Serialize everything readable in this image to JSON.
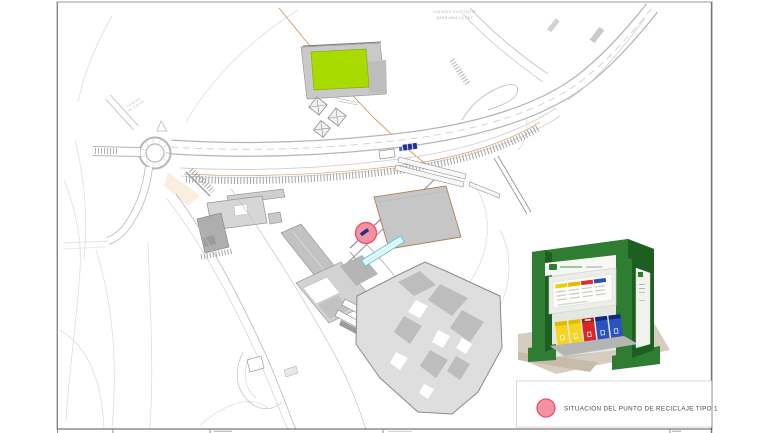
{
  "sheet": {
    "background": "#ffffff",
    "frame_color": "#9a9a9a"
  },
  "annotations": {
    "school_label_line1": "COLEGIO EXISTENTE",
    "school_label_line2": "BARRIADA LA PAZ",
    "health_label_line1": "CENTRO",
    "health_label_line2": "DE SALUD"
  },
  "map": {
    "colors": {
      "sports_court": "#a8dc00",
      "sports_court_stroke": "#86b300",
      "ramp_fill": "#eafafc",
      "ramp_stroke": "#4cc9d9",
      "boundary": "#d09a62",
      "existing_containers": "#23309b"
    },
    "recycling_marker": {
      "fill": "#f492a0",
      "stroke": "#e8556e",
      "symbol_color": "#24308f"
    }
  },
  "inset": {
    "subject": "punto-de-reciclaje-3d-render",
    "structure_green": "#2e7d32",
    "structure_green_dark": "#1d5e21",
    "structure_green_light": "#43a047",
    "ground": "#d6cdbe",
    "bins": [
      {
        "color": "#f5d520"
      },
      {
        "color": "#f5d520"
      },
      {
        "color": "#d8262a"
      },
      {
        "color": "#2a53c0"
      },
      {
        "color": "#2a53c0"
      }
    ]
  },
  "legend": {
    "label": "SITUACIÓN DEL PUNTO DE RECICLAJE TIPO 1",
    "marker_fill": "#f492a0",
    "marker_stroke": "#e8556e"
  }
}
